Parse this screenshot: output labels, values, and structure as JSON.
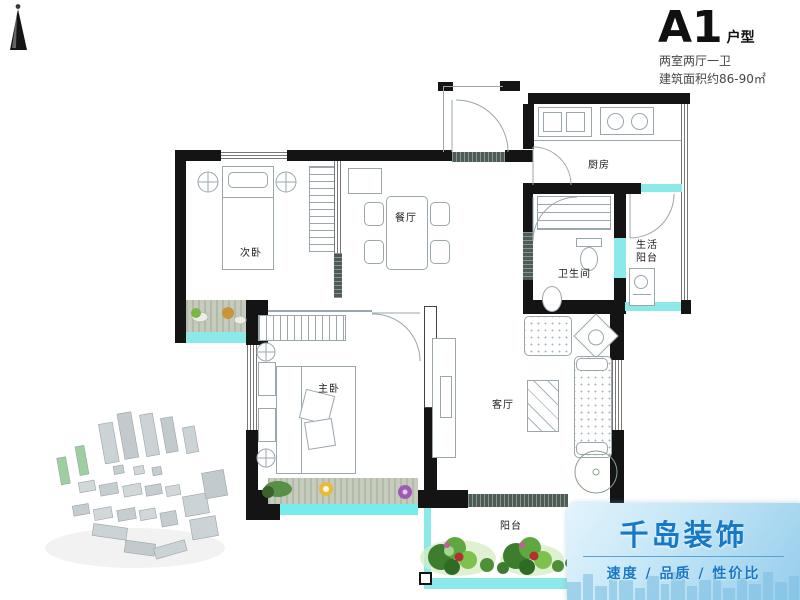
{
  "header": {
    "plan_code": "A1",
    "plan_code_suffix": "户型",
    "spec_line1": "两室两厅一卫",
    "spec_line2": "建筑面积约86-90㎡"
  },
  "rooms": {
    "secondary_bedroom": "次卧",
    "dining_room": "餐厅",
    "kitchen": "厨房",
    "bathroom": "卫生间",
    "utility_balcony": [
      "生活",
      "阳台"
    ],
    "master_bedroom": "主卧",
    "living_room": "客厅",
    "balcony": "阳台"
  },
  "logo": {
    "brand": "千岛装饰",
    "tagline": "速度 / 品质 / 性价比"
  },
  "colors": {
    "wall": "#141414",
    "window_cyan": "#8ce9e9",
    "logo_blue": "#1778c6",
    "logo_bg_top": "#e3f4fd",
    "logo_bg_bottom": "#96cdec"
  }
}
